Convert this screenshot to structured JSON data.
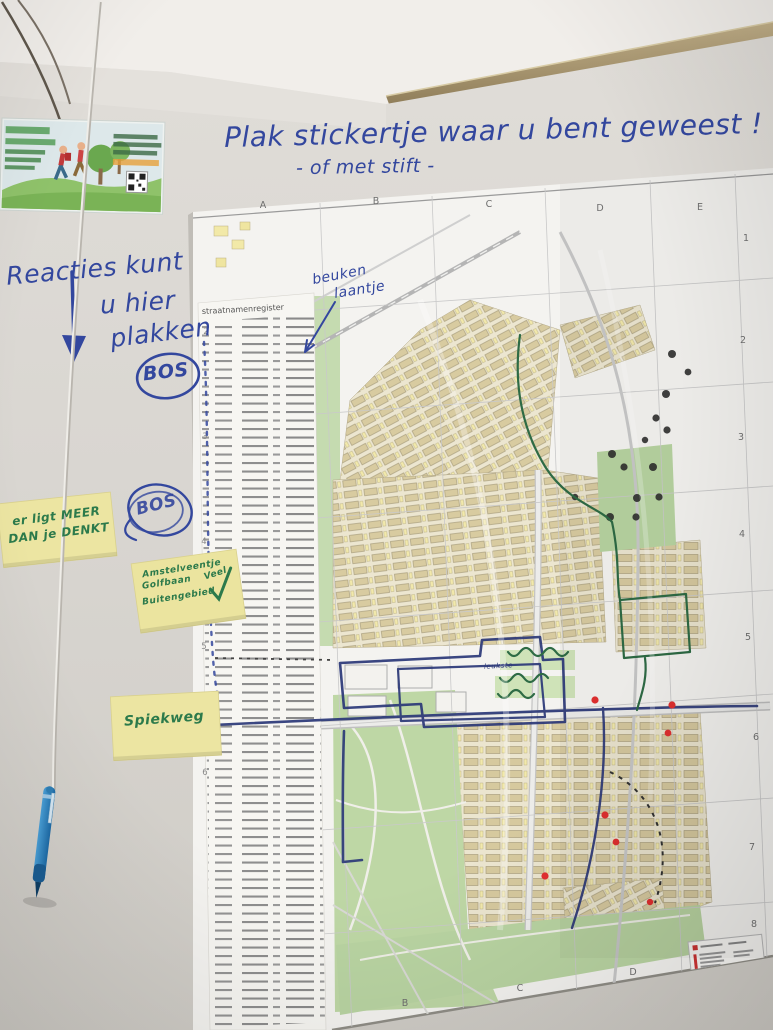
{
  "title": {
    "line1": "Plak stickertje waar u bent geweest !",
    "line2": "- of met stift -"
  },
  "wall": {
    "reactions_note": {
      "line1": "Reacties kunt",
      "line2": "u hier",
      "line3": "plakken"
    },
    "circled_word_1": "BOS",
    "circled_word_2": "BOS"
  },
  "sticky_notes": [
    {
      "lines": [
        "er ligt MEER",
        "DAN je DENKT"
      ]
    },
    {
      "lines": [
        "Amstelveentje",
        "Golfbaan",
        "Buitengebied"
      ],
      "annotation": "Veel"
    },
    {
      "lines": [
        "Spiekweg"
      ]
    }
  ],
  "map": {
    "register_title": "straatnamenregister",
    "handwritten_label": {
      "line1": "beuken",
      "line2": "laantje"
    },
    "loop_label": "leukste",
    "grid_columns_top": [
      "A",
      "B",
      "C",
      "D",
      "E"
    ],
    "grid_columns_bottom": [
      "B",
      "C",
      "D"
    ],
    "grid_rows_right": [
      "1",
      "2",
      "3",
      "4",
      "5",
      "6",
      "7",
      "8"
    ],
    "grid_rows_left": [
      "2",
      "3",
      "4",
      "5",
      "6"
    ]
  },
  "colors": {
    "ink_blue": "#33479e",
    "marker_green": "#2c7a4b",
    "route_navy": "#2b3878",
    "route_green": "#2e6b45",
    "sticker_black": "#2a2a2a",
    "sticker_red": "#e23030",
    "note_yellow": "#ece5a2",
    "map_park_green": "#bcd6a2",
    "building_tan": "#d8cba0"
  }
}
